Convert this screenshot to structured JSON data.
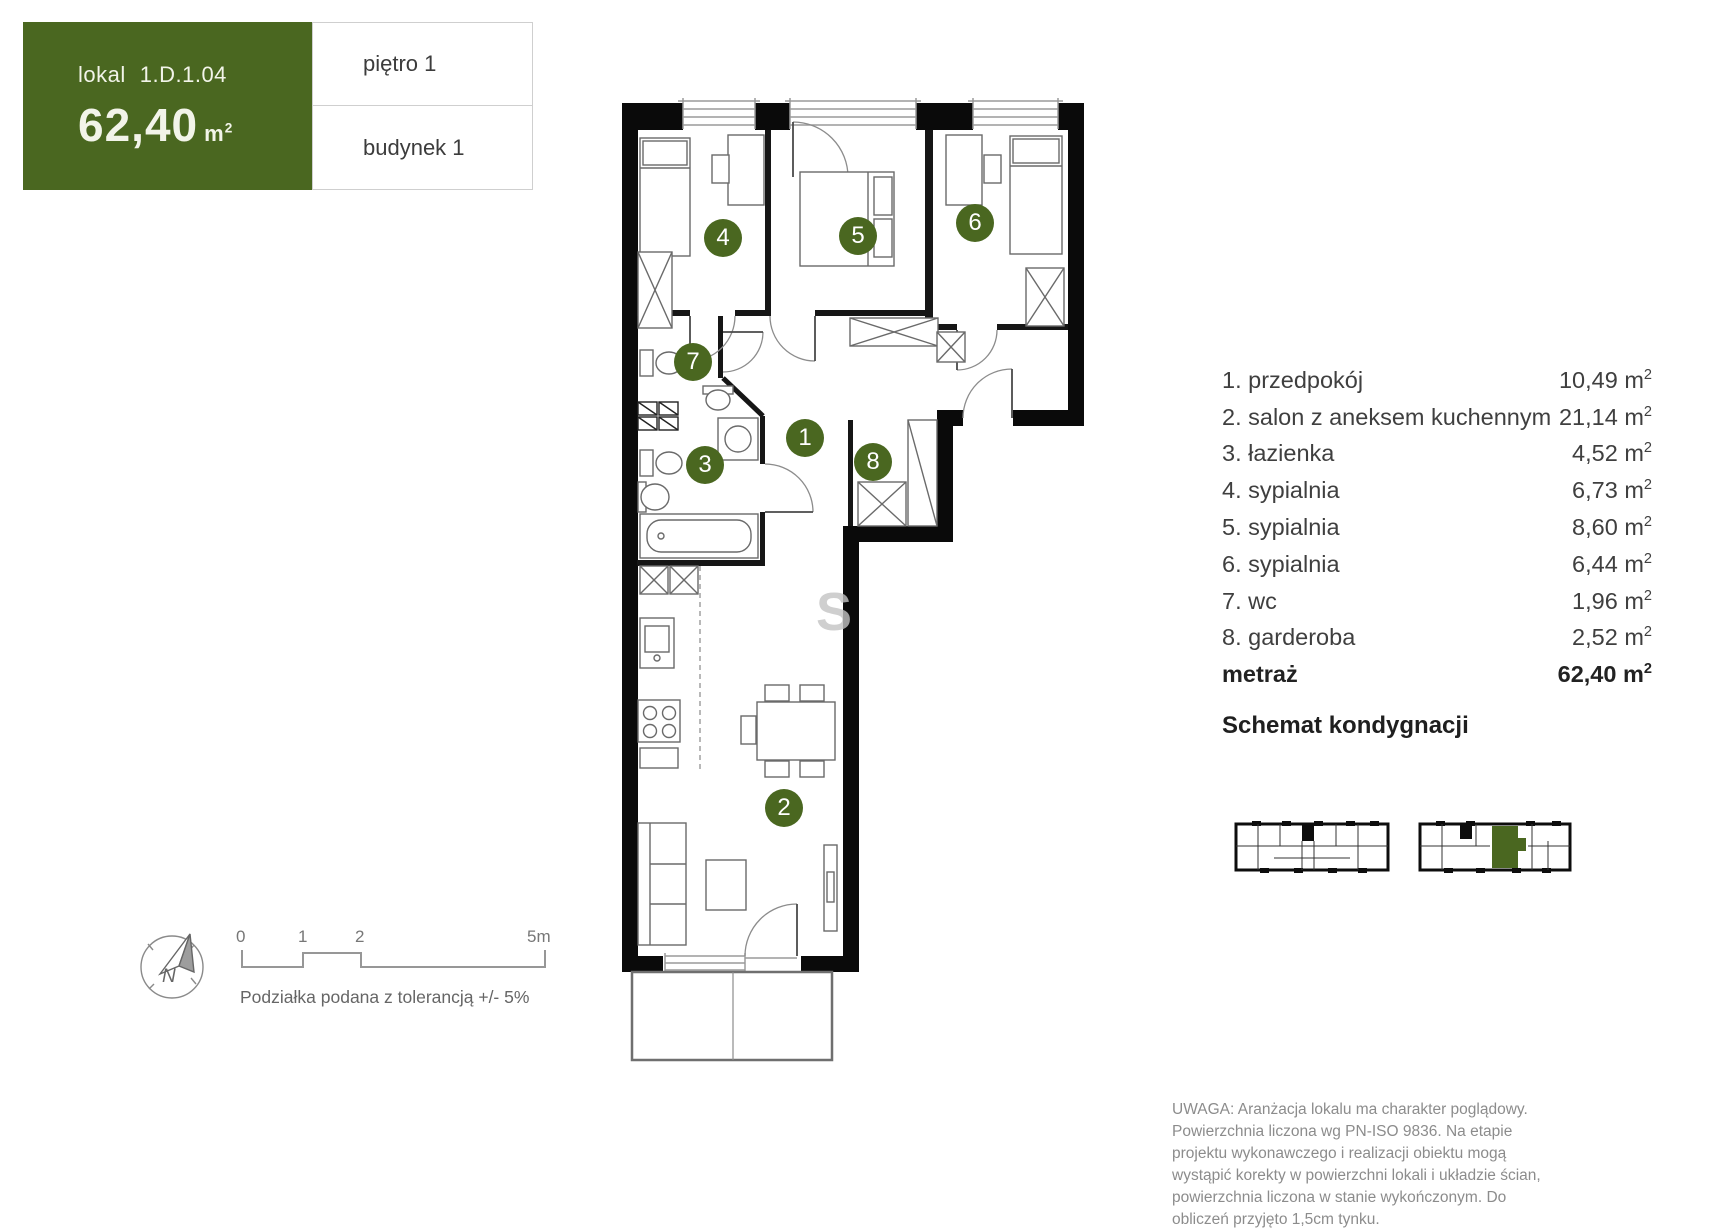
{
  "header": {
    "lokal_label": "lokal",
    "lokal_id": "1.D.1.04",
    "area_value": "62,40",
    "floor": "piętro 1",
    "building": "budynek 1"
  },
  "units": {
    "base": "m",
    "exp": "2"
  },
  "rooms": [
    {
      "num": "1",
      "label": "1. przedpokój",
      "value": "10,49"
    },
    {
      "num": "2",
      "label": "2. salon z aneksem kuchennym",
      "value": "21,14"
    },
    {
      "num": "3",
      "label": "3. łazienka",
      "value": "4,52"
    },
    {
      "num": "4",
      "label": "4. sypialnia",
      "value": "6,73"
    },
    {
      "num": "5",
      "label": "5. sypialnia",
      "value": "8,60"
    },
    {
      "num": "6",
      "label": "6. sypialnia",
      "value": "6,44"
    },
    {
      "num": "7",
      "label": "7. wc",
      "value": "1,96"
    },
    {
      "num": "8",
      "label": "8. garderoba",
      "value": "2,52"
    }
  ],
  "summary": {
    "label": "metraż",
    "value": "62,40"
  },
  "schemat_heading": "Schemat kondygnacji",
  "scale": {
    "t0": "0",
    "t1": "1",
    "t2": "2",
    "t5": "5m",
    "caption": "Podziałka podana z tolerancją +/- 5%"
  },
  "compass": {
    "label": "N"
  },
  "watermark": "S",
  "disclaimer": "UWAGA: Aranżacja lokalu ma charakter poglądowy. Powierzchnia liczona wg PN-ISO 9836. Na etapie projektu wykonawczego i realizacji obiektu mogą wystąpić korekty w powierzchni lokali i układzie ścian, powierzchnia liczona w stanie wykończonym. Do obliczeń przyjęto 1,5cm tynku.",
  "colors": {
    "green": "#4a6720"
  }
}
